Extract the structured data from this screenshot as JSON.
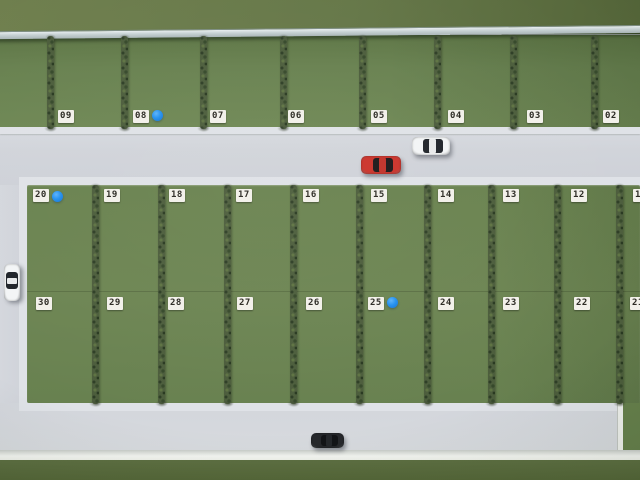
{
  "plots": {
    "row_top": [
      "09",
      "08",
      "07",
      "06",
      "05",
      "04",
      "03",
      "02"
    ],
    "row_middle": [
      "20",
      "19",
      "18",
      "17",
      "16",
      "15",
      "14",
      "13",
      "12",
      "11"
    ],
    "row_bottom": [
      "30",
      "29",
      "28",
      "27",
      "26",
      "25",
      "24",
      "23",
      "22",
      "21"
    ],
    "blue_marker_plots": [
      "08",
      "20",
      "25"
    ]
  },
  "cars": [
    {
      "id": "car-white-main-road",
      "body_color": "#f3f5f6",
      "glass_color": "#20242a"
    },
    {
      "id": "car-red-main-road",
      "body_color": "#cb322a",
      "glass_color": "#1d1719"
    },
    {
      "id": "car-white-west-road",
      "body_color": "#f3f5f6",
      "glass_color": "#20242a"
    },
    {
      "id": "car-dark-south-road",
      "body_color": "#26282c",
      "glass_color": "#121417"
    }
  ],
  "colors": {
    "field_green": "#6a8351",
    "hedge_green": "#4c5d3c",
    "road_gray": "#d2d5db",
    "sidewalk_gray": "#dfe2e7",
    "curb_white": "#f2f4f0",
    "outer_grass_top": "#657748",
    "outer_grass_bottom": "#5d6f42",
    "wall_gray": "#c6d1d3",
    "marker_blue": "#2391f0",
    "label_bg": "#f2f0ea",
    "label_text": "#2b2923",
    "car_white": "#f3f5f6",
    "car_red": "#cb322a",
    "car_dark": "#26282c"
  }
}
